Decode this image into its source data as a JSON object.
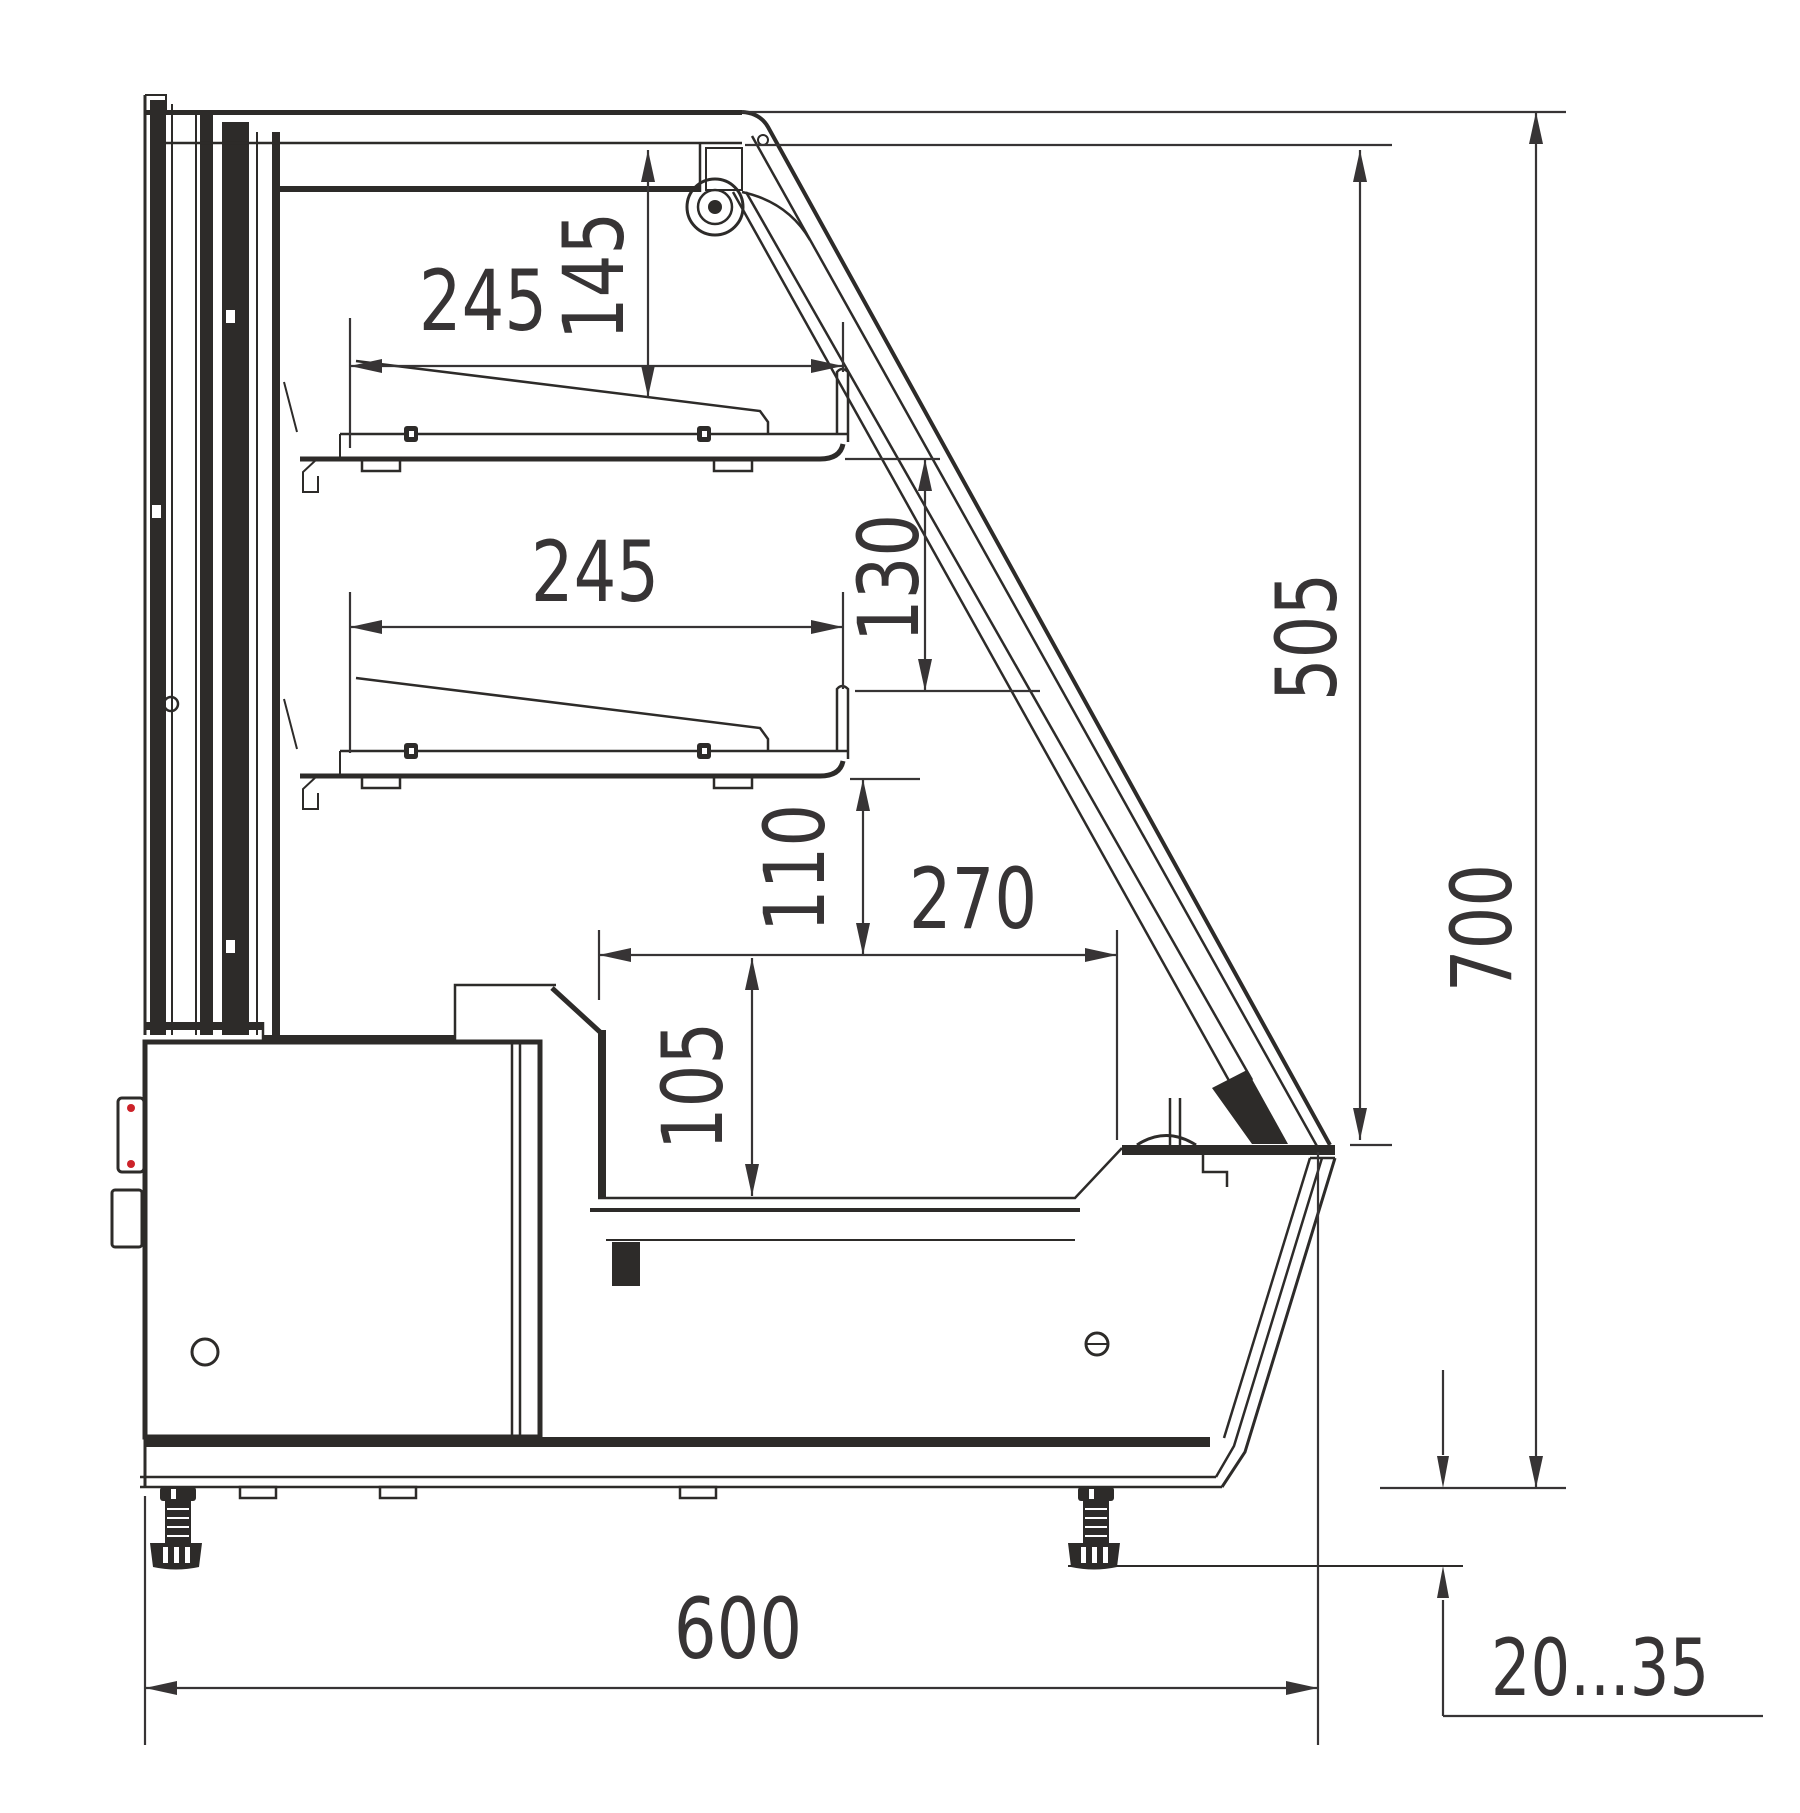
{
  "drawing": {
    "type": "technical-section-drawing",
    "subject": "refrigerated confectionery display case - side cross section",
    "background_color": "#ffffff",
    "line_color": "#2d2b29",
    "accent_red": "#cc2229",
    "dims": {
      "shelf1_width": "245",
      "shelf1_clearance": "145",
      "shelf2_width": "245",
      "shelf2_clearance": "130",
      "glass_opening_height": "505",
      "overall_height": "700",
      "well_clearance": "110",
      "well_width": "270",
      "well_depth": "105",
      "overall_depth": "600",
      "foot_adjustment": "20...35"
    }
  }
}
